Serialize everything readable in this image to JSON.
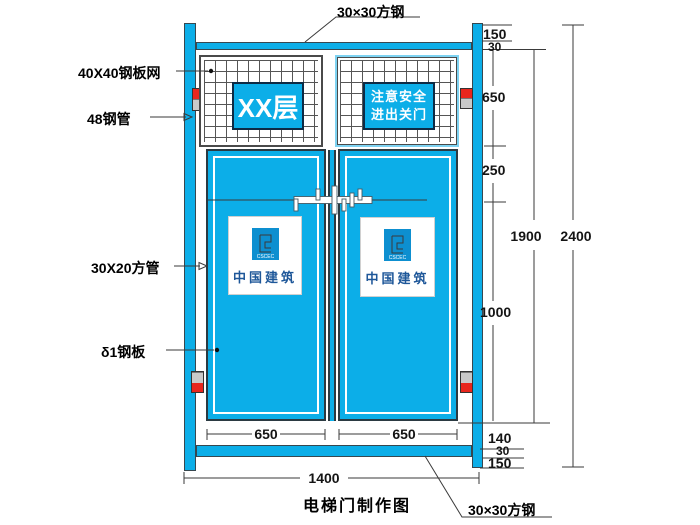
{
  "title": "电梯门制作图",
  "callouts": {
    "top_steel": "30×30方钢",
    "bottom_steel": "30×30方钢",
    "mesh": "40X40钢板网",
    "pipe": "48钢管",
    "square_tube": "30X20方管",
    "steel_plate": "δ1钢板"
  },
  "signs": {
    "floor_sign": "XX层",
    "safety_line1": "注意安全",
    "safety_line2": "进出关门"
  },
  "logo": {
    "mark": "CSCEC",
    "wordmark": "中国建筑"
  },
  "dimensions": {
    "right_chain": {
      "top_offset": "150",
      "top_tube": "30",
      "mesh_opening": "650",
      "upper_panel": "250",
      "lower_panel": "1000",
      "bottom_gap": "140",
      "bottom_tube": "30",
      "bottom_offset": "150"
    },
    "door_frame_height": "1900",
    "overall_height": "2400",
    "left_door_width": "650",
    "right_door_width": "650",
    "overall_width": "1400"
  },
  "colors": {
    "panel_blue": "#0caee8",
    "clamp_red": "#e8261d",
    "clamp_gray": "#c9c9c9",
    "line_dark": "#3a3a3a"
  }
}
